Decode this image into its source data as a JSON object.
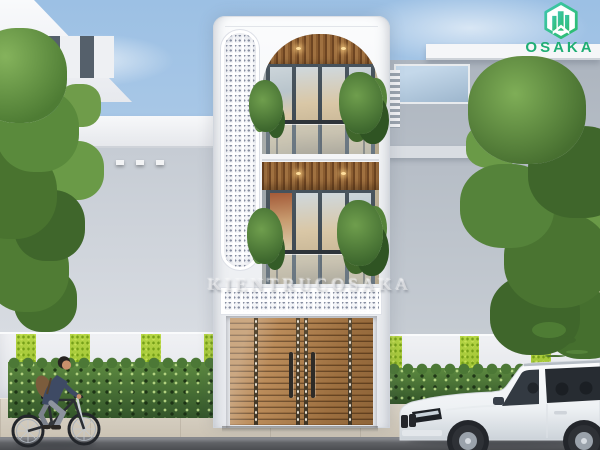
{
  "logo": {
    "text": "OSAKA",
    "icon": "hexagon-skyline-logo-icon",
    "text_color": "#1fae74",
    "gradient": [
      "#3fc6ae",
      "#2bbc6c"
    ]
  },
  "watermark": {
    "text": "KIENTRUCOSAKA"
  },
  "scene": {
    "description": "3D exterior render of a narrow three-storey white townhouse between two neighbouring modern houses, with a cyclist and a white SUV on the street",
    "palette": {
      "sky_top": "#9cc0e4",
      "sky_bottom": "#e2eaf4",
      "facade_white": "#f6f7f9",
      "neighbor_wall_gray": "#adb5bf",
      "wood_slat_ceiling": "#9c6a38",
      "gate_wood": "#9b6b3a",
      "window_frame": "#46525c",
      "foliage_green": "#4e7c34",
      "moss_stripe_green": "#9fc32f",
      "hedge_green": "#4c7a36",
      "sidewalk_beige": "#d5cfc2",
      "street_gray": "#5a5c60",
      "car_white": "#f3f5f7",
      "downlight_warm": "#ffdf9e"
    },
    "elements": [
      "main-townhouse",
      "breeze-block-capsule-column",
      "breeze-block-band",
      "arched-balcony-floor-3",
      "balcony-floor-2",
      "wood-slat-gate",
      "left-neighbor-house",
      "right-neighbor-house",
      "green-striped-fence",
      "hedge",
      "street-trees",
      "white-suv",
      "cyclist"
    ]
  }
}
